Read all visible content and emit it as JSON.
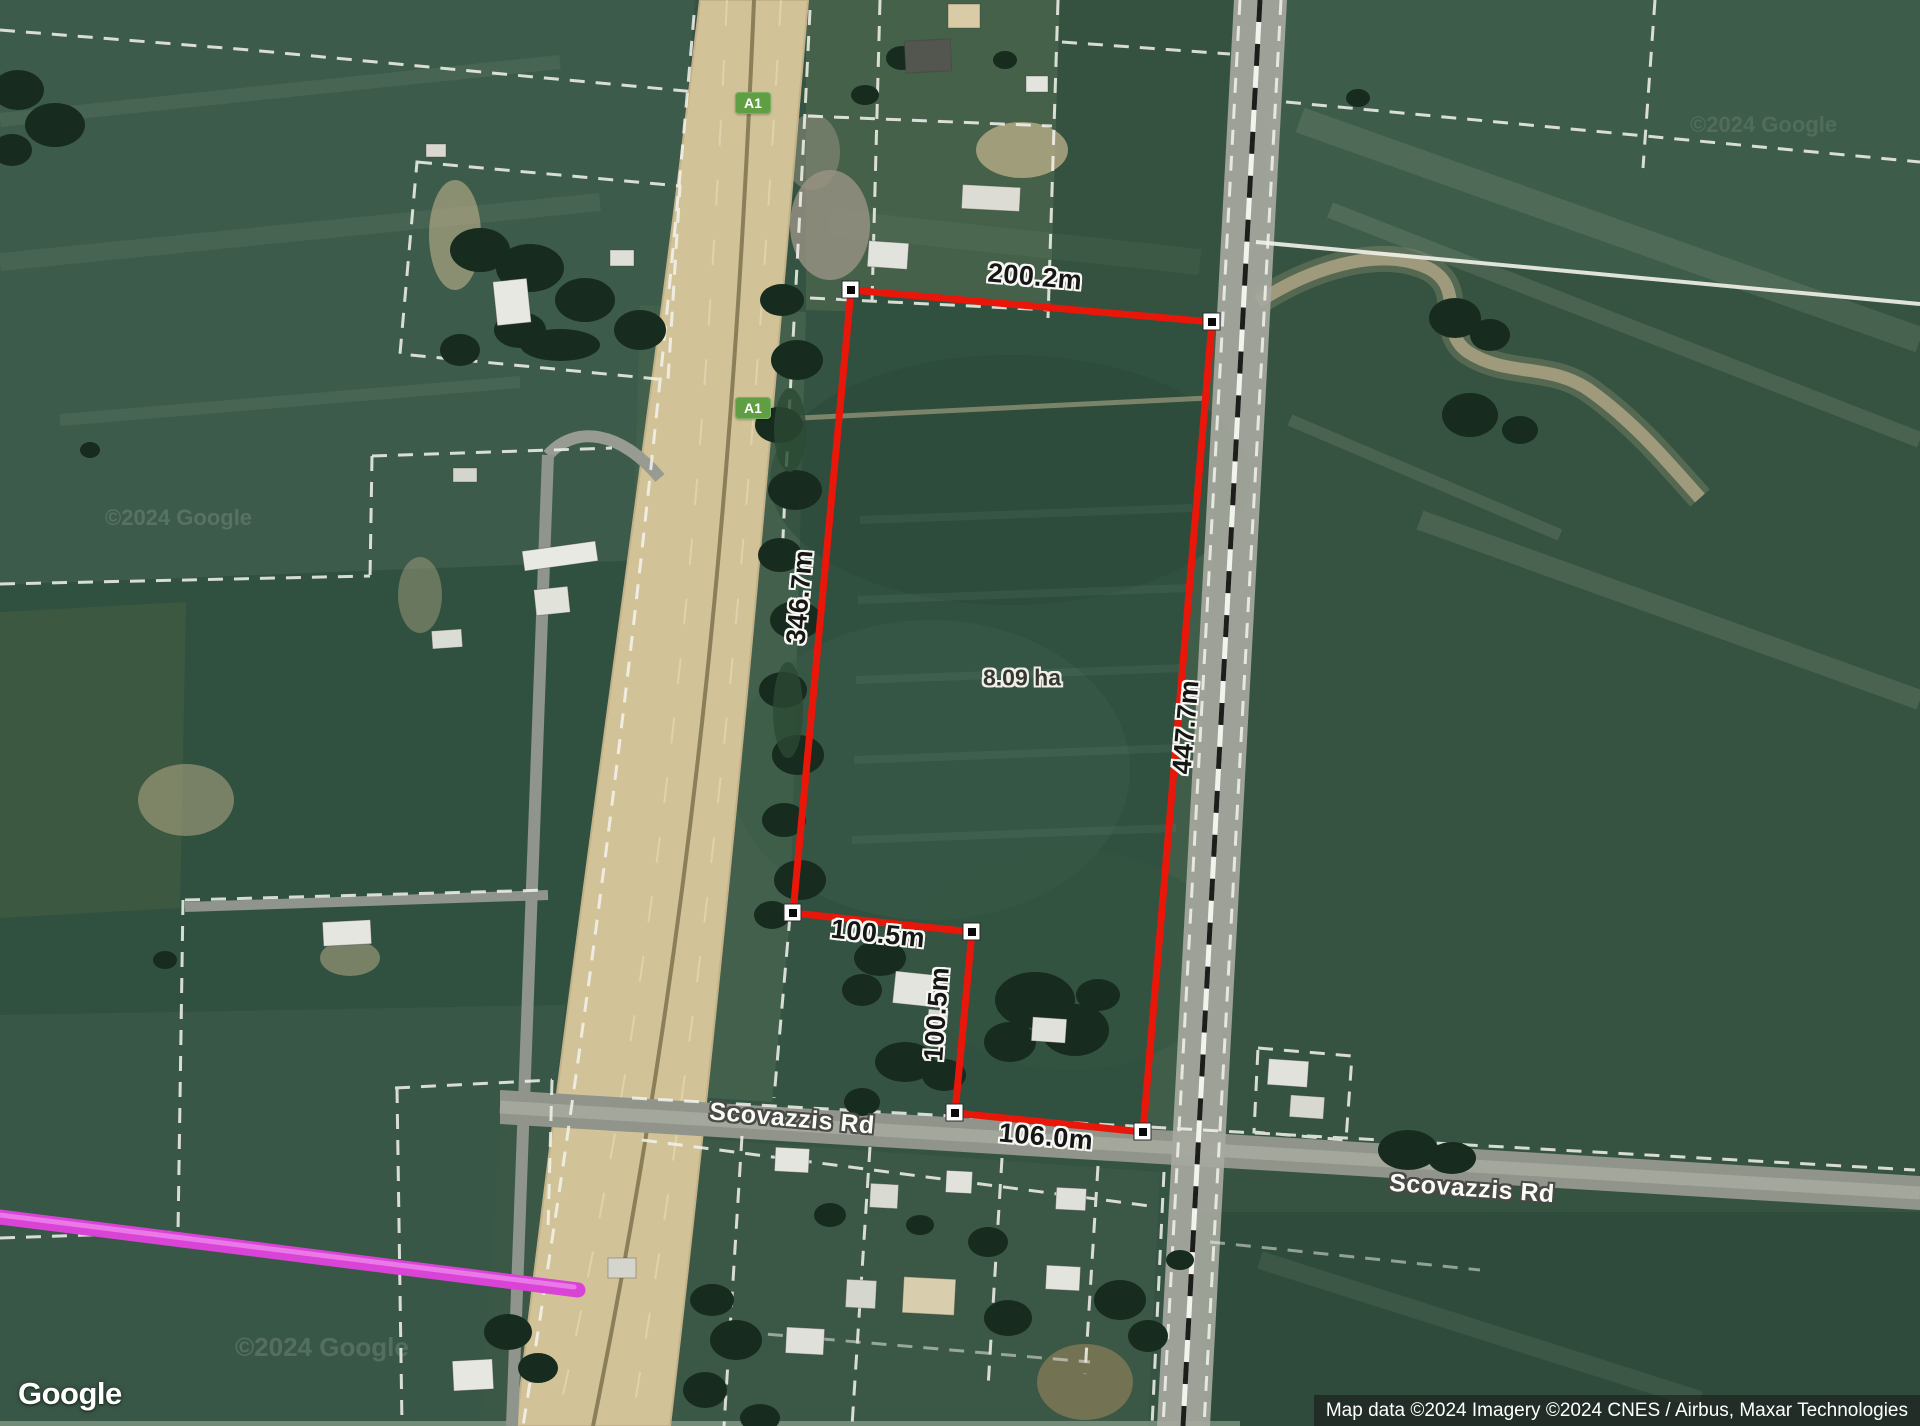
{
  "map": {
    "area_label": "8.09 ha",
    "measurements": {
      "top": "200.2m",
      "left": "346.7m",
      "right": "447.7m",
      "notch_top": "100.5m",
      "notch_side": "100.5m",
      "bottom": "106.0m"
    },
    "roads": {
      "name_west": "Scovazzis Rd",
      "name_east": "Scovazzis Rd",
      "highway_shield": "A1"
    },
    "branding": {
      "logo": "Google"
    },
    "attribution": "Map data ©2024 Imagery ©2024 CNES / Airbus, Maxar Technologies",
    "watermark": "©2024 Google",
    "colors": {
      "parcel_outline": "#e8170a",
      "shield_green": "#5f9e43",
      "survey_line": "#d944d6"
    }
  }
}
